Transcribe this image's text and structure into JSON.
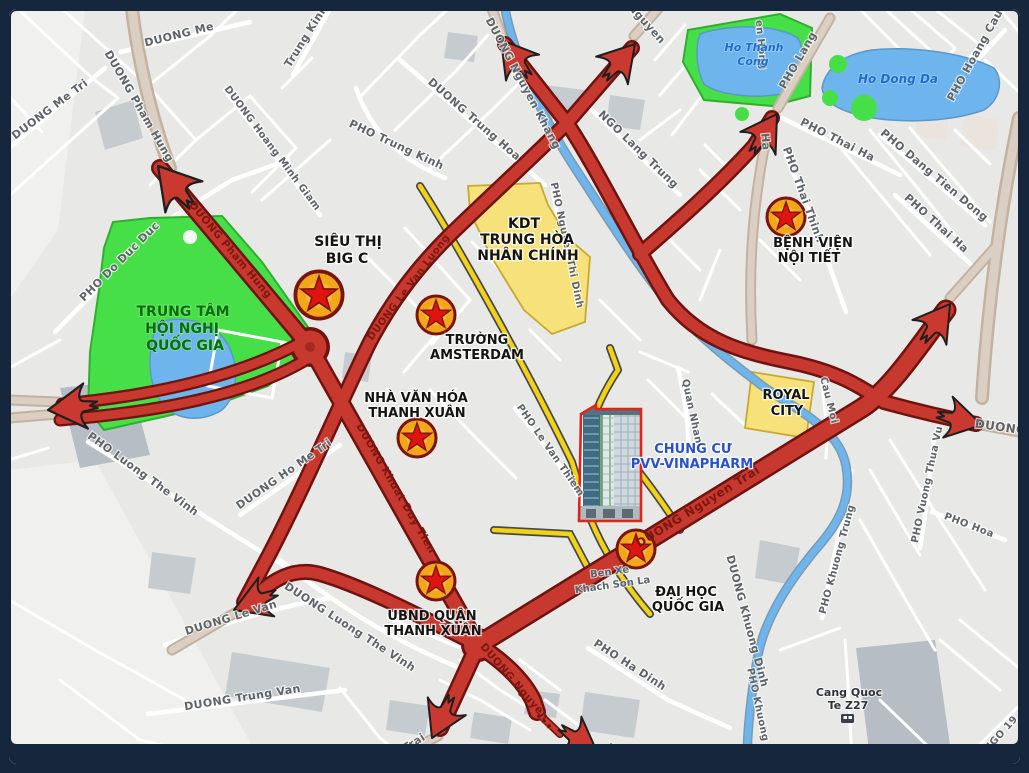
{
  "colors": {
    "frame": "#16263c",
    "map_background": "#e8e9e7",
    "route_red": "#c7382e",
    "route_casing": "#6e1310",
    "street_yellow": "#f2d218",
    "park_green": "#47df47",
    "water_blue": "#6db5ec",
    "zone_yellow": "#f6e17a",
    "highlight_label_blue": "#2a52c8"
  },
  "map": {
    "stars": [
      {
        "id": "sieu-thi-big-c",
        "x": 319,
        "y": 295,
        "scale": 1.18
      },
      {
        "id": "truong-amsterdam",
        "x": 436,
        "y": 315,
        "scale": 0.95
      },
      {
        "id": "benh-vien-noi-tiet",
        "x": 786,
        "y": 217,
        "scale": 0.95
      },
      {
        "id": "nha-van-hoa-thanh-xuan",
        "x": 417,
        "y": 438,
        "scale": 0.95
      },
      {
        "id": "ubnd-quan-thanh-xuan",
        "x": 436,
        "y": 581,
        "scale": 0.95
      },
      {
        "id": "dai-hoc-quoc-gia",
        "x": 636,
        "y": 549,
        "scale": 0.95
      }
    ],
    "labels": [
      {
        "t": "DUONG Me Tri",
        "x": 52,
        "y": 112,
        "r": -37,
        "s": 11,
        "k": "road"
      },
      {
        "t": "DUONG Pham Hung",
        "x": 136,
        "y": 108,
        "r": 60,
        "s": 11,
        "k": "road"
      },
      {
        "t": "DUONG Me",
        "x": 180,
        "y": 38,
        "r": -14,
        "s": 11,
        "k": "road"
      },
      {
        "t": "Trung Kinh",
        "x": 309,
        "y": 38,
        "r": -58,
        "s": 11,
        "k": "road"
      },
      {
        "t": "DUONG Hoang Minh Giam",
        "x": 270,
        "y": 150,
        "r": 53,
        "s": 10,
        "k": "road"
      },
      {
        "t": "PHO Trung Kinh",
        "x": 395,
        "y": 148,
        "r": 25,
        "s": 11,
        "k": "road"
      },
      {
        "t": "DUONG Nguyen Khang",
        "x": 520,
        "y": 85,
        "r": 62,
        "s": 11,
        "k": "road"
      },
      {
        "t": "DUONG Trung Hoa",
        "x": 472,
        "y": 122,
        "r": 41,
        "s": 11,
        "k": "road"
      },
      {
        "t": "NGO Lang Trung",
        "x": 636,
        "y": 152,
        "r": 44,
        "s": 11,
        "k": "road"
      },
      {
        "t": "Nguyen",
        "x": 644,
        "y": 26,
        "r": 48,
        "s": 11,
        "k": "road"
      },
      {
        "t": "en Hong",
        "x": 758,
        "y": 45,
        "r": 85,
        "s": 10,
        "k": "road"
      },
      {
        "t": "PHO Lang",
        "x": 801,
        "y": 62,
        "r": -60,
        "s": 11,
        "k": "road"
      },
      {
        "t": "Ha",
        "x": 762,
        "y": 142,
        "r": 85,
        "s": 11,
        "k": "road"
      },
      {
        "t": "PHO Hoang Cau",
        "x": 978,
        "y": 57,
        "r": -61,
        "s": 11,
        "k": "road"
      },
      {
        "t": "PHO Thai Ha",
        "x": 836,
        "y": 143,
        "r": 27,
        "s": 11,
        "k": "road"
      },
      {
        "t": "PHO Dang Tien Dong",
        "x": 932,
        "y": 178,
        "r": 40,
        "s": 11,
        "k": "road"
      },
      {
        "t": "PHO Thai Thinh",
        "x": 800,
        "y": 196,
        "r": 70,
        "s": 11,
        "k": "road"
      },
      {
        "t": "PHO Thai Ha",
        "x": 934,
        "y": 226,
        "r": 42,
        "s": 11,
        "k": "road"
      },
      {
        "t": "PHO Do Duc Duc",
        "x": 122,
        "y": 264,
        "r": -45,
        "s": 11,
        "k": "road"
      },
      {
        "t": "PHO Nguyen Thi Dinh",
        "x": 564,
        "y": 246,
        "r": 78,
        "s": 10,
        "k": "road"
      },
      {
        "t": "Quan Nhan",
        "x": 689,
        "y": 412,
        "r": 78,
        "s": 10,
        "k": "road"
      },
      {
        "t": "PHO Le Van Thiem",
        "x": 548,
        "y": 452,
        "r": 55,
        "s": 10,
        "k": "road"
      },
      {
        "t": "DUONG Ho Me Tri",
        "x": 286,
        "y": 477,
        "r": -35,
        "s": 11,
        "k": "road"
      },
      {
        "t": "PHO Luong The Vinh",
        "x": 141,
        "y": 477,
        "r": 36,
        "s": 11,
        "k": "road"
      },
      {
        "t": "DUONG Luong The Vinh",
        "x": 348,
        "y": 630,
        "r": 33,
        "s": 11,
        "k": "road"
      },
      {
        "t": "DUONG Le Van",
        "x": 232,
        "y": 621,
        "r": -17,
        "s": 11,
        "k": "road"
      },
      {
        "t": "DUONG Trung Van",
        "x": 243,
        "y": 701,
        "r": -9,
        "s": 11,
        "k": "road"
      },
      {
        "t": "PHO Ha Dinh",
        "x": 628,
        "y": 668,
        "r": 33,
        "s": 11,
        "k": "road"
      },
      {
        "t": "yen Trai",
        "x": 404,
        "y": 753,
        "r": -32,
        "s": 11,
        "k": "road"
      },
      {
        "t": "DUONG Khuong Dinh",
        "x": 744,
        "y": 622,
        "r": 75,
        "s": 11,
        "k": "road"
      },
      {
        "t": "PHO Khuong Ha",
        "x": 757,
        "y": 715,
        "r": 78,
        "s": 10,
        "k": "road"
      },
      {
        "t": "PHO Khuong Trung",
        "x": 840,
        "y": 560,
        "r": -75,
        "s": 10,
        "k": "road"
      },
      {
        "t": "PHO Vuong Thua Vu",
        "x": 930,
        "y": 485,
        "r": -78,
        "s": 10,
        "k": "road"
      },
      {
        "t": "PHO Hoa",
        "x": 968,
        "y": 528,
        "r": 21,
        "s": 10,
        "k": "road"
      },
      {
        "t": "DUONG",
        "x": 1000,
        "y": 431,
        "r": 8,
        "s": 12,
        "k": "road"
      },
      {
        "t": "Cau Moi",
        "x": 826,
        "y": 401,
        "r": 76,
        "s": 10,
        "k": "road"
      },
      {
        "t": "NGO 19",
        "x": 1003,
        "y": 736,
        "r": -48,
        "s": 10,
        "k": "road"
      },
      {
        "t": "Xien",
        "x": 618,
        "y": 757,
        "r": 33,
        "s": 11,
        "k": "road"
      },
      {
        "t": "DUONG Pham Hung",
        "x": 228,
        "y": 252,
        "r": 50,
        "s": 10.5,
        "k": "roadred"
      },
      {
        "t": "DUONG Khuat Duy Tien",
        "x": 393,
        "y": 490,
        "r": 60,
        "s": 10.5,
        "k": "roadred"
      },
      {
        "t": "DUONG Le Van Luong",
        "x": 411,
        "y": 289,
        "r": -53,
        "s": 10,
        "k": "roadred"
      },
      {
        "t": "DUONG Nguyen Trai",
        "x": 700,
        "y": 510,
        "r": -32,
        "s": 12,
        "k": "roadred"
      },
      {
        "t": "DUONG Nguyen",
        "x": 512,
        "y": 684,
        "r": 49,
        "s": 10.5,
        "k": "roadred"
      },
      {
        "t": "Ho Thanh",
        "x": 754,
        "y": 51,
        "r": 0,
        "s": 11,
        "k": "water"
      },
      {
        "t": "Cong",
        "x": 753,
        "y": 65,
        "r": 0,
        "s": 11,
        "k": "water"
      },
      {
        "t": "Ho Dong Da",
        "x": 898,
        "y": 83,
        "r": 0,
        "s": 12,
        "k": "water"
      },
      {
        "id": "label-sieu-thi",
        "t": "SIÊU THỊ",
        "x": 348,
        "y": 246,
        "r": 0,
        "s": 14,
        "k": "lm"
      },
      {
        "id": "label-big-c",
        "t": "BIG C",
        "x": 347,
        "y": 263,
        "r": 0,
        "s": 14,
        "k": "lm"
      },
      {
        "id": "label-truong",
        "t": "TRƯỜNG",
        "x": 477,
        "y": 344,
        "r": 0,
        "s": 13,
        "k": "lm"
      },
      {
        "id": "label-amsterdam",
        "t": "AMSTERDAM",
        "x": 477,
        "y": 359,
        "r": 0,
        "s": 13,
        "k": "lm"
      },
      {
        "id": "label-benh-vien",
        "t": "BỆNH VIỆN",
        "x": 813,
        "y": 247,
        "r": 0,
        "s": 13,
        "k": "lm"
      },
      {
        "id": "label-noi-tiet",
        "t": "NỘI TIẾT",
        "x": 809,
        "y": 262,
        "r": 0,
        "s": 13,
        "k": "lm"
      },
      {
        "id": "label-nha-van-hoa",
        "t": "NHÀ VĂN HÓA",
        "x": 416,
        "y": 402,
        "r": 0,
        "s": 13,
        "k": "lm"
      },
      {
        "id": "label-nvh-thanh-xuan",
        "t": "THANH XUÂN",
        "x": 417,
        "y": 417,
        "r": 0,
        "s": 13,
        "k": "lm"
      },
      {
        "id": "label-ubnd",
        "t": "UBND QUẬN",
        "x": 432,
        "y": 620,
        "r": 0,
        "s": 13,
        "k": "lm"
      },
      {
        "id": "label-ubnd-thanh-xuan",
        "t": "THANH XUÂN",
        "x": 433,
        "y": 635,
        "r": 0,
        "s": 13,
        "k": "lm"
      },
      {
        "id": "label-dai-hoc",
        "t": "ĐẠI HỌC",
        "x": 686,
        "y": 596,
        "r": 0,
        "s": 13,
        "k": "lm"
      },
      {
        "id": "label-dh-quoc-gia",
        "t": "QUỐC GIA",
        "x": 688,
        "y": 611,
        "r": 0,
        "s": 13,
        "k": "lm"
      },
      {
        "id": "label-trung-tam",
        "t": "TRUNG TÂM",
        "x": 183,
        "y": 316,
        "r": 0,
        "s": 14,
        "k": "lmgreen"
      },
      {
        "id": "label-hoi-nghi",
        "t": "HỘI NGHỊ",
        "x": 182,
        "y": 333,
        "r": 0,
        "s": 14,
        "k": "lmgreen"
      },
      {
        "id": "label-tt-quoc-gia",
        "t": "QUỐC GIA",
        "x": 185,
        "y": 350,
        "r": 0,
        "s": 14,
        "k": "lmgreen"
      },
      {
        "id": "label-kdt",
        "t": "KDT",
        "x": 524,
        "y": 228,
        "r": 0,
        "s": 14,
        "k": "lm"
      },
      {
        "id": "label-trung-hoa",
        "t": "TRUNG HÒA",
        "x": 527,
        "y": 244,
        "r": 0,
        "s": 14,
        "k": "lm"
      },
      {
        "id": "label-nhan-chinh",
        "t": "NHÂN CHÍNH",
        "x": 528,
        "y": 260,
        "r": 0,
        "s": 14,
        "k": "lm"
      },
      {
        "id": "label-royal",
        "t": "ROYAL",
        "x": 786,
        "y": 399,
        "r": 0,
        "s": 13,
        "k": "lm"
      },
      {
        "id": "label-city",
        "t": "CITY",
        "x": 787,
        "y": 415,
        "r": 0,
        "s": 13,
        "k": "lm"
      },
      {
        "id": "label-chung-cu",
        "t": "CHUNG CƯ",
        "x": 693,
        "y": 453,
        "r": 0,
        "s": 13,
        "k": "lmblue"
      },
      {
        "id": "label-pvv-vinapharm",
        "t": "PVV-VINAPHARM",
        "x": 692,
        "y": 468,
        "r": 0,
        "s": 13,
        "k": "lmblue"
      },
      {
        "id": "label-ben-xe",
        "t": "Ben Xe",
        "x": 610,
        "y": 575,
        "r": -8,
        "s": 10,
        "k": "lmgray"
      },
      {
        "id": "label-khach-son-la",
        "t": "Khach Son La",
        "x": 613,
        "y": 588,
        "r": -8,
        "s": 10,
        "k": "lmgray"
      },
      {
        "id": "label-cang-quoc",
        "t": "Cang Quoc",
        "x": 849,
        "y": 696,
        "r": 0,
        "s": 11,
        "k": "lmdark"
      },
      {
        "id": "label-te-z27",
        "t": "Te Z27",
        "x": 848,
        "y": 709,
        "r": 0,
        "s": 11,
        "k": "lmdark"
      }
    ]
  }
}
